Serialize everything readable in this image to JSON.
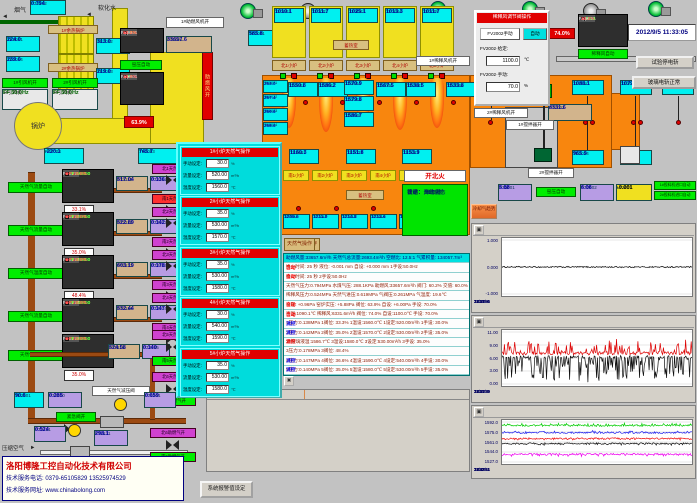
{
  "app": {
    "datetime": "2012/9/5 11:33:05"
  },
  "top_left": {
    "flue_gas": "烟气",
    "soft_water": "软化水",
    "boiler": "锅炉",
    "whb1": "1#余热锅炉",
    "whb2": "2#余热锅炉",
    "fan1_on": "1#引风机开",
    "fan2_on": "2#引风机开",
    "fan1": "1#引风机",
    "fan2": "2#引风机",
    "hz1": "FF 50.0Hz",
    "hz2": "FF 50.0Hz",
    "comb_fan_on": "1#助燃风机开",
    "comb_air_bar": "助燃风开",
    "kiln_auto": "窑压自动",
    "pct": "63.9%",
    "pt2202": {
      "tag": "PT2202",
      "v": "0.794"
    },
    "te2061": {
      "tag": "TE2061",
      "v": "224.0"
    },
    "te2062": {
      "tag": "TE2062",
      "v": "313.0"
    },
    "te2063": {
      "tag": "TE2063",
      "v": "219.0"
    },
    "te2064": {
      "tag": "TE2064",
      "v": "239.0"
    },
    "pt2003": {
      "tag": "PT2003",
      "v": "-220.1"
    },
    "te2053": {
      "tag": "TE2053",
      "v": "745.7"
    },
    "te2051": {
      "tag": "TE2051",
      "v": "585.8"
    },
    "ft2001": {
      "tag": "FT2001",
      "v": "33657.6"
    },
    "pv3001": {
      "title": "PV3001",
      "rows": [
        {
          "k": "FF",
          "v": "80.2%",
          "c": "#ffe040"
        },
        {
          "k": "OP",
          "v": "80.1%",
          "c": "#ff5050"
        }
      ]
    },
    "pv2001": {
      "title": "PV2001",
      "rows": [
        {
          "k": "PF",
          "v": "5.88",
          "c": "#ffffff"
        },
        {
          "k": "SP",
          "v": "6.00",
          "c": "#40ff40"
        },
        {
          "k": "OP",
          "v": "78.0%",
          "c": "#ff5050"
        }
      ]
    }
  },
  "regen": {
    "label": "蓄热室",
    "label2": "蓄热室",
    "burners": [
      {
        "te": "TE3001",
        "v": "1010.1",
        "label": "北1小炉"
      },
      {
        "te": "TE3002",
        "v": "1011.7",
        "label": "北2小炉"
      },
      {
        "te": "TE3003",
        "v": "1025.1",
        "label": "北3小炉"
      },
      {
        "te": "TE3004",
        "v": "1013.3",
        "label": "北4小炉"
      },
      {
        "te": "TE3005",
        "v": "1011.7",
        "label": "北5小炉"
      }
    ]
  },
  "furnace": {
    "te_top": [
      {
        "tag": "TE2001",
        "v": "1550.8"
      },
      {
        "tag": "TE2002",
        "v": "1586.2"
      },
      {
        "tag": "TE2004",
        "v": "1570.9"
      },
      {
        "tag": "TE2003",
        "v": "1579.8"
      },
      {
        "tag": "TE2005",
        "v": "1586.7"
      },
      {
        "tag": "TE2006",
        "v": "1567.5"
      },
      {
        "tag": "TE2007",
        "v": "1538.5"
      },
      {
        "tag": "TE2008",
        "v": "1533.8"
      }
    ],
    "te_left": [
      {
        "tag": "TE2071",
        "v": "263.0"
      },
      {
        "tag": "TE2072",
        "v": "267.4"
      },
      {
        "tag": "TE2073",
        "v": "269.6"
      },
      {
        "tag": "TE2074",
        "v": "268.6"
      }
    ],
    "te_bottom": [
      {
        "tag": "TE2021",
        "v": "1160.3"
      },
      {
        "tag": "TE2022",
        "v": "1151.8"
      },
      {
        "tag": "TE2023",
        "v": "1153.9"
      }
    ],
    "te_right": [
      {
        "tag": "TE2009",
        "v": "1523.1"
      },
      {
        "tag": "TE2010",
        "v": "1088.1"
      },
      {
        "tag": "TE2011",
        "v": "1079.6"
      },
      {
        "tag": "TE2012",
        "v": "1090.1"
      },
      {
        "tag": "TE2024",
        "v": "965.9"
      },
      {
        "tag": "TE2025",
        "v": "965.8"
      }
    ],
    "south": [
      {
        "label": "南1小炉",
        "te": "TE2041",
        "v": "1209.6"
      },
      {
        "label": "南2小炉",
        "te": "TE2042",
        "v": "1211.0"
      },
      {
        "label": "南3小炉",
        "te": "TE2043",
        "v": "1214.8"
      },
      {
        "label": "南4小炉",
        "te": "TE2044",
        "v": "1212.6"
      },
      {
        "label": "南5小炉",
        "te": "TE2045",
        "v": "1211.8"
      }
    ],
    "stir1": "1#搅拌器开",
    "stir2": "2#搅拌器开",
    "dilfan1": "1#稀释风机开",
    "dilfan2": "2#稀释风机开"
  },
  "fire": {
    "indicator": "开北火",
    "rows": [
      "状态：自动状态",
      "自动：开北火",
      "设定： 1175 秒",
      "计时：  269 秒"
    ]
  },
  "op_buttons": [
    "稀释风操作",
    "引风机操作",
    "窑压操作",
    "玻璃液位操作",
    "天然气操作"
  ],
  "dilution_popup": {
    "title": "稀释风调节阀操作",
    "manual_btn": "FV2002手动",
    "auto_btn": "自动",
    "row1_label": "FV2002·给定:",
    "row1_value": "1100.0",
    "row1_unit": "℃",
    "row2_label": "FV2002·手动:",
    "row2_value": "70.0",
    "row2_unit": "%"
  },
  "pv2002": {
    "title": "PV2002",
    "rows": [
      {
        "k": "PF",
        "v": "1090.1",
        "c": "#ffffff"
      },
      {
        "k": "SP",
        "v": "1100.0",
        "c": "#40ff40"
      },
      {
        "k": "OP",
        "v": "70.0%",
        "c": "#ff5050"
      }
    ]
  },
  "top_right": {
    "pct": "74.0%",
    "dil_auto": "稀释风自动",
    "ft2002": {
      "tag": "FT2002",
      "v": "8331.6"
    },
    "btn1": "试验停电斩",
    "btn2": "玻璃电斩正常"
  },
  "gas_loops": [
    {
      "auto": "天然气流量自动",
      "tag": "FV2211",
      "spt": "SPT 1560.0",
      "spf": "SPF 520.00",
      "op": "OP 20.0%",
      "ft_tag": "FT2211",
      "ft_v": "517.04",
      "pt_tag": "PT2211",
      "pt_v": "0.136",
      "pct": "33.1%",
      "vn": "北1天然气开",
      "vnbg": "#d042d0",
      "vs": "南1天然气开",
      "vsbg": "#ff3030"
    },
    {
      "auto": "天然气流量自动",
      "tag": "FV2212",
      "spt": "SPT 1570.0",
      "spf": "SPF 530.00",
      "op": "OP 20.0%",
      "ft_tag": "FT2212",
      "ft_v": "522.89",
      "pt_tag": "PT2212",
      "pt_v": "0.142",
      "pct": "35.0%",
      "vn": "北2天然气开",
      "vnbg": "#d042d0",
      "vs": "南2天然气开",
      "vsbg": "#d042d0"
    },
    {
      "auto": "天然气温度自动",
      "tag": "FV2213",
      "spt": "SPT 1580.0",
      "spf": "SPF 530.00",
      "op": "OP 20.0%",
      "ft_tag": "FT2213",
      "ft_v": "603.19",
      "pt_tag": "PT2213",
      "pt_v": "0.178",
      "pct": "48.4%",
      "vn": "北3天然气开",
      "vnbg": "#d042d0",
      "vs": "南3天然气开",
      "vsbg": "#d042d0"
    },
    {
      "auto": "天然气流量自动",
      "tag": "FV2214",
      "spt": "SPT 1590.0",
      "spf": "SPF 540.00",
      "op": "OP 20.0%",
      "ft_tag": "FT2214",
      "ft_v": "532.44",
      "pt_tag": "PT2214",
      "pt_v": "0.147",
      "pct": "38.6%",
      "vn": "北4天然气开",
      "vnbg": "#d042d0",
      "vs": "南4天然气开",
      "vsbg": "#d042d0"
    }
  ],
  "loop5": {
    "auto": "天然气流量自动",
    "tag": "FV2215",
    "spt": "SPT 1580.0",
    "spf": "SPF 530.00",
    "op": "OP 20.0%",
    "ft_tag": "FT2215",
    "ft_v": "524.58",
    "pt_tag": "PT2215",
    "pt_v": "0.140",
    "pct": "35.0%",
    "vn": "北5天然气开",
    "vs": "南5天然气开",
    "vn2": "北6天然气开",
    "vs2": "南6天然气开"
  },
  "lower_left": {
    "regulator": "天然气减压阀",
    "emergency": "紧急阀开",
    "comp_air": "压缩空气",
    "te2201": {
      "tag": "TE2201",
      "v": "90.6"
    },
    "pt2200": {
      "tag": "PT2200",
      "v": "0.285"
    },
    "ft2201": {
      "tag": "FT2201",
      "v": "0.659"
    },
    "pt2121": {
      "tag": "PT2121",
      "v": "0.524"
    },
    "ft2131": {
      "tag": "FT2131",
      "v": "298.1"
    },
    "vn": "北6助燃气开",
    "vs": "南6助燃气开"
  },
  "company": {
    "name": "洛阳博隆工控自动化技术有限公司",
    "phone": "技术服务电话: 0379-65105829  13525974529",
    "web": "技术服务网址: www.chinabolong.com"
  },
  "status_rows": [
    {
      "text": "助燃风量:33657.6m³/h  天然气总流量:2693.4m³/h  空燃比: 12.5:1  气累积量: 134057.7m³",
      "tag": "",
      "c": ""
    },
    {
      "text": "换火时间:  25 秒   液位:  -0.001 mm   自设:  +0.000 mm   1手设:50.0Hz",
      "tag": "自动",
      "c": "#ff0000"
    },
    {
      "text": "换火时间:  25 秒   2手设:50.0Hz",
      "tag": "自动",
      "c": "#ff0000"
    },
    {
      "text": "天然气压力:0.794MPa  水煤气压: 288.1KPa  助燃风:33657.6m³/h  阀门: 60.2%  交值: 60.0%",
      "tag": "",
      "c": ""
    },
    {
      "text": "稀释风压力:0.524MPa  天然气进压:0.619MPa  气阀压:0.261MPa  气温度: 19.6℃",
      "tag": "",
      "c": ""
    },
    {
      "text": "窑压: +0.96Pa  窑炉实压: +5.88Pa  阀位: 63.9%  自设: +6.00Pa  手设: 70.0%",
      "tag": "自动",
      "c": "#ff0000"
    },
    {
      "text": "窑温:1090.1℃  稀释风:6331.6m³/h  阀位: 74.0%  自设:1100.0℃  手设: 70.0%",
      "tag": "自动",
      "c": "#ff0000"
    },
    {
      "text": "1压力:0.138MPa 1阀位: 33.3% 1温设:1560.0℃ 1设定:520.00m³/h 1手设: 30.0%",
      "tag": "流控",
      "c": "#0000ee"
    },
    {
      "text": "2压力:0.142MPa 2阀位: 35.0% 2温设:1570.0℃ 2设定:530.00m³/h 2手设: 35.0%",
      "tag": "流控",
      "c": "#0000ee"
    },
    {
      "text": "3#玻璃液温:1586.7℃  3温设:1580.0℃ 3设定:530.00m³/h 3手设: 35.0%",
      "tag": "温控",
      "c": "#ee0000"
    },
    {
      "text": "3压力:0.178MPa 3阀位: 48.4%",
      "tag": "",
      "c": ""
    },
    {
      "text": "4压力:0.147MPa 4阀位: 36.6% 4温设:1590.0℃ 4设定:540.00m³/h 4手设: 30.0%",
      "tag": "流控",
      "c": "#0000ee"
    },
    {
      "text": "5压力:0.140MPa 5阀位: 35.0% 5温设:1580.0℃ 5设定:530.00m³/h 5手设: 35.0%",
      "tag": "流控",
      "c": "#0000ee"
    }
  ],
  "alarm": {
    "toolbar": [
      "▤",
      "≡",
      "?",
      "▦",
      "▦",
      "▦",
      "▦",
      "⇄",
      "○",
      "⇅",
      "✖"
    ],
    "col_point": "故障点",
    "col_cause": "故障原因（供参考）",
    "rows": [
      {
        "i": "16",
        "n": "98",
        "d": "2012/09/05",
        "t": "11:17:21",
        "p": "3#小炉气量FT2213过高或过低",
        "c": "调整3#小炉天然气调节阀或减压阀"
      },
      {
        "i": "17",
        "n": "84",
        "d": "2012/09/05",
        "t": "11:17:21",
        "p": "4#小炉气压PT2214过高或过低",
        "c": "调整4#小炉天然气调节阀或减压阀"
      },
      {
        "i": "18",
        "n": "97",
        "d": "2012/09/05",
        "t": "11:17:25",
        "p": "4#小炉流量FT2214过高或过低",
        "c": "调整4#小炉调节阀回路自动控制"
      },
      {
        "i": "19",
        "n": "75",
        "d": "2012/09/05",
        "t": "11:17:26",
        "p": "5#小炉气量FT2215过高或过低",
        "c": "调整5#小炉天然气调节阀或减压阀"
      },
      {
        "i": "20",
        "n": "82",
        "d": "2012/09/05",
        "t": "11:17:30",
        "p": "富氧空气压力PT2122过高或过低",
        "c": "调整富氧空气调节阀门回路"
      },
      {
        "i": "21",
        "n": "85",
        "d": "2012/09/05",
        "t": "11:17:33",
        "p": "2#小炉流量FT2112过高或过低",
        "c": "调整2#小炉调节阀回路自动控制"
      },
      {
        "i": "22",
        "n": "81",
        "d": "2012/09/05",
        "t": "11:17:33",
        "p": "5#小炉流量FT2115过高或过低",
        "c": "调整5#小炉调节阀回路自动控制"
      },
      {
        "i": "23",
        "n": "83",
        "d": "2012/09/05",
        "t": "11:17:33",
        "p": "1#小炉流量FT2111过高或过低",
        "c": "调整1#小炉调节阀回路自动控制"
      }
    ]
  },
  "right_inds": {
    "pt3001": {
      "tag": "PT3001",
      "v": "5.88"
    },
    "kiln_auto": "窑压自动",
    "pt2002": {
      "tag": "PT2002",
      "v": "6.06"
    },
    "lt2001": {
      "tag": "LT2001",
      "v": "-0.001"
    },
    "feeder1": "1#投料机进口自动",
    "feeder2": "2#投料机进口自动"
  },
  "trend_buttons": [
    "窑温度趋势",
    "烟道趋势",
    "助燃风趋势",
    "稀释风趋势",
    "窑压趋势",
    "液位趋势",
    "天然气趋势",
    "冷却气趋势"
  ],
  "burner_popup": {
    "lbl1": "手动设定:",
    "lbl2": "流量设定:",
    "lbl3": "温度设定:",
    "u1": "%",
    "u2": "m³/h",
    "u3": "℃",
    "r1": "手动控制",
    "r2": "流量自控",
    "r3": "温度自控",
    "panels": [
      {
        "title": "1#小炉天然气操作",
        "f1": "30.0",
        "f2": "520.00",
        "f3": "1560.0",
        "d1": "○",
        "d2": "●",
        "d3": "○"
      },
      {
        "title": "2#小炉天然气操作",
        "f1": "35.0",
        "f2": "530.00",
        "f3": "1570.0",
        "d1": "○",
        "d2": "●",
        "d3": "○"
      },
      {
        "title": "3#小炉天然气操作",
        "f1": "35.0",
        "f2": "530.00",
        "f3": "1580.0",
        "d1": "○",
        "d2": "○",
        "d3": "●"
      },
      {
        "title": "4#小炉天然气操作",
        "f1": "30.0",
        "f2": "540.00",
        "f3": "1590.0",
        "d1": "○",
        "d2": "●",
        "d3": "○"
      },
      {
        "title": "5#小炉天然气操作",
        "f1": "35.0",
        "f2": "530.00",
        "f3": "1580.0",
        "d1": "○",
        "d2": "●",
        "d3": "○"
      }
    ]
  },
  "bottom_buttons": [
    "窑炉控制系统",
    "配料控制系统",
    "天然气PID参数设定",
    "稀释风PID参数设定",
    "窑压PID参数设定",
    "玻璃液位PID参数设定",
    "窑炉烧嘴报警记录",
    "窑炉数据记录",
    "系统报警值设定"
  ],
  "chart_data": [
    {
      "type": "line",
      "toolbar": [
        "▤",
        "|◀",
        "◀◀",
        "▶▶",
        "▶|",
        "✖",
        "⊕",
        "↔",
        "▣"
      ],
      "yticks": [
        "1.000",
        "0.000",
        "-1.000"
      ],
      "xticks": [
        "12/09/04",
        "11:31:56",
        "15:31:56",
        "19:31:56",
        "23:31:56",
        "3:31:56",
        "7:31:56",
        "11:31:56"
      ],
      "ymin": -1.3,
      "ymax": 1.3,
      "grid": true,
      "legend": "none",
      "series": [
        {
          "color": "#101010",
          "center": 0,
          "jitter": 0.03,
          "spike": 0,
          "amp": 0,
          "dir": 1
        }
      ]
    },
    {
      "type": "line",
      "toolbar": [
        "▤",
        "|◀",
        "◀◀",
        "▶▶",
        "▶|",
        "✖",
        "⊕",
        "↔",
        "▣"
      ],
      "yticks": [
        "11.00",
        "9.00",
        "6.00",
        "3.00",
        "0.00"
      ],
      "xticks": [
        "12/09/04",
        "11:31:29",
        "15:31:29",
        "19:31:29",
        "23:31:29",
        "3:31:29",
        "7:31:29",
        "11:31:29"
      ],
      "ymin": 0,
      "ymax": 11.8,
      "grid": true,
      "legend": "none",
      "series": [
        {
          "color": "#dd0000",
          "center": 6.9,
          "jitter": 0.35,
          "spike": 0.33,
          "amp": 2.7,
          "dir": 1
        },
        {
          "color": "#101010",
          "center": 6.1,
          "jitter": 0.3,
          "spike": 0.5,
          "amp": 5.2,
          "dir": -1
        }
      ]
    },
    {
      "type": "line",
      "toolbar": [
        "⚷",
        "▤",
        "|◀",
        "◀◀",
        "▶▶",
        "▶|",
        "✖",
        "⊕",
        "↔",
        "▣"
      ],
      "yticks": [
        "1592.0",
        "1575.0",
        "1561.0",
        "1544.0",
        "1527.0"
      ],
      "xticks": [
        "12/09/04",
        "11:32:51",
        "15:32:51",
        "19:32:51",
        "23:32:51",
        "3:32:51",
        "7:32:51",
        "11:32:51"
      ],
      "ymin": 1523,
      "ymax": 1597,
      "grid": true,
      "legend": "none",
      "series": [
        {
          "color": "#00cc00",
          "center": 1587.5,
          "jitter": 1.3,
          "spike": 0.4,
          "amp": 3.0,
          "dir": 1
        },
        {
          "color": "#2020ee",
          "center": 1575.5,
          "jitter": 1.2,
          "spike": 0.3,
          "amp": 2.5,
          "dir": 1
        },
        {
          "color": "#ee1010",
          "center": 1566.0,
          "jitter": 1.2,
          "spike": 0.3,
          "amp": 2.0,
          "dir": -1
        },
        {
          "color": "#101010",
          "center": 1557.5,
          "jitter": 1.2,
          "spike": 0.3,
          "amp": 2.0,
          "dir": -1
        },
        {
          "color": "#ee00ee",
          "center": 1539.5,
          "jitter": 1.4,
          "spike": 0.3,
          "amp": 2.5,
          "dir": -1
        }
      ]
    }
  ]
}
